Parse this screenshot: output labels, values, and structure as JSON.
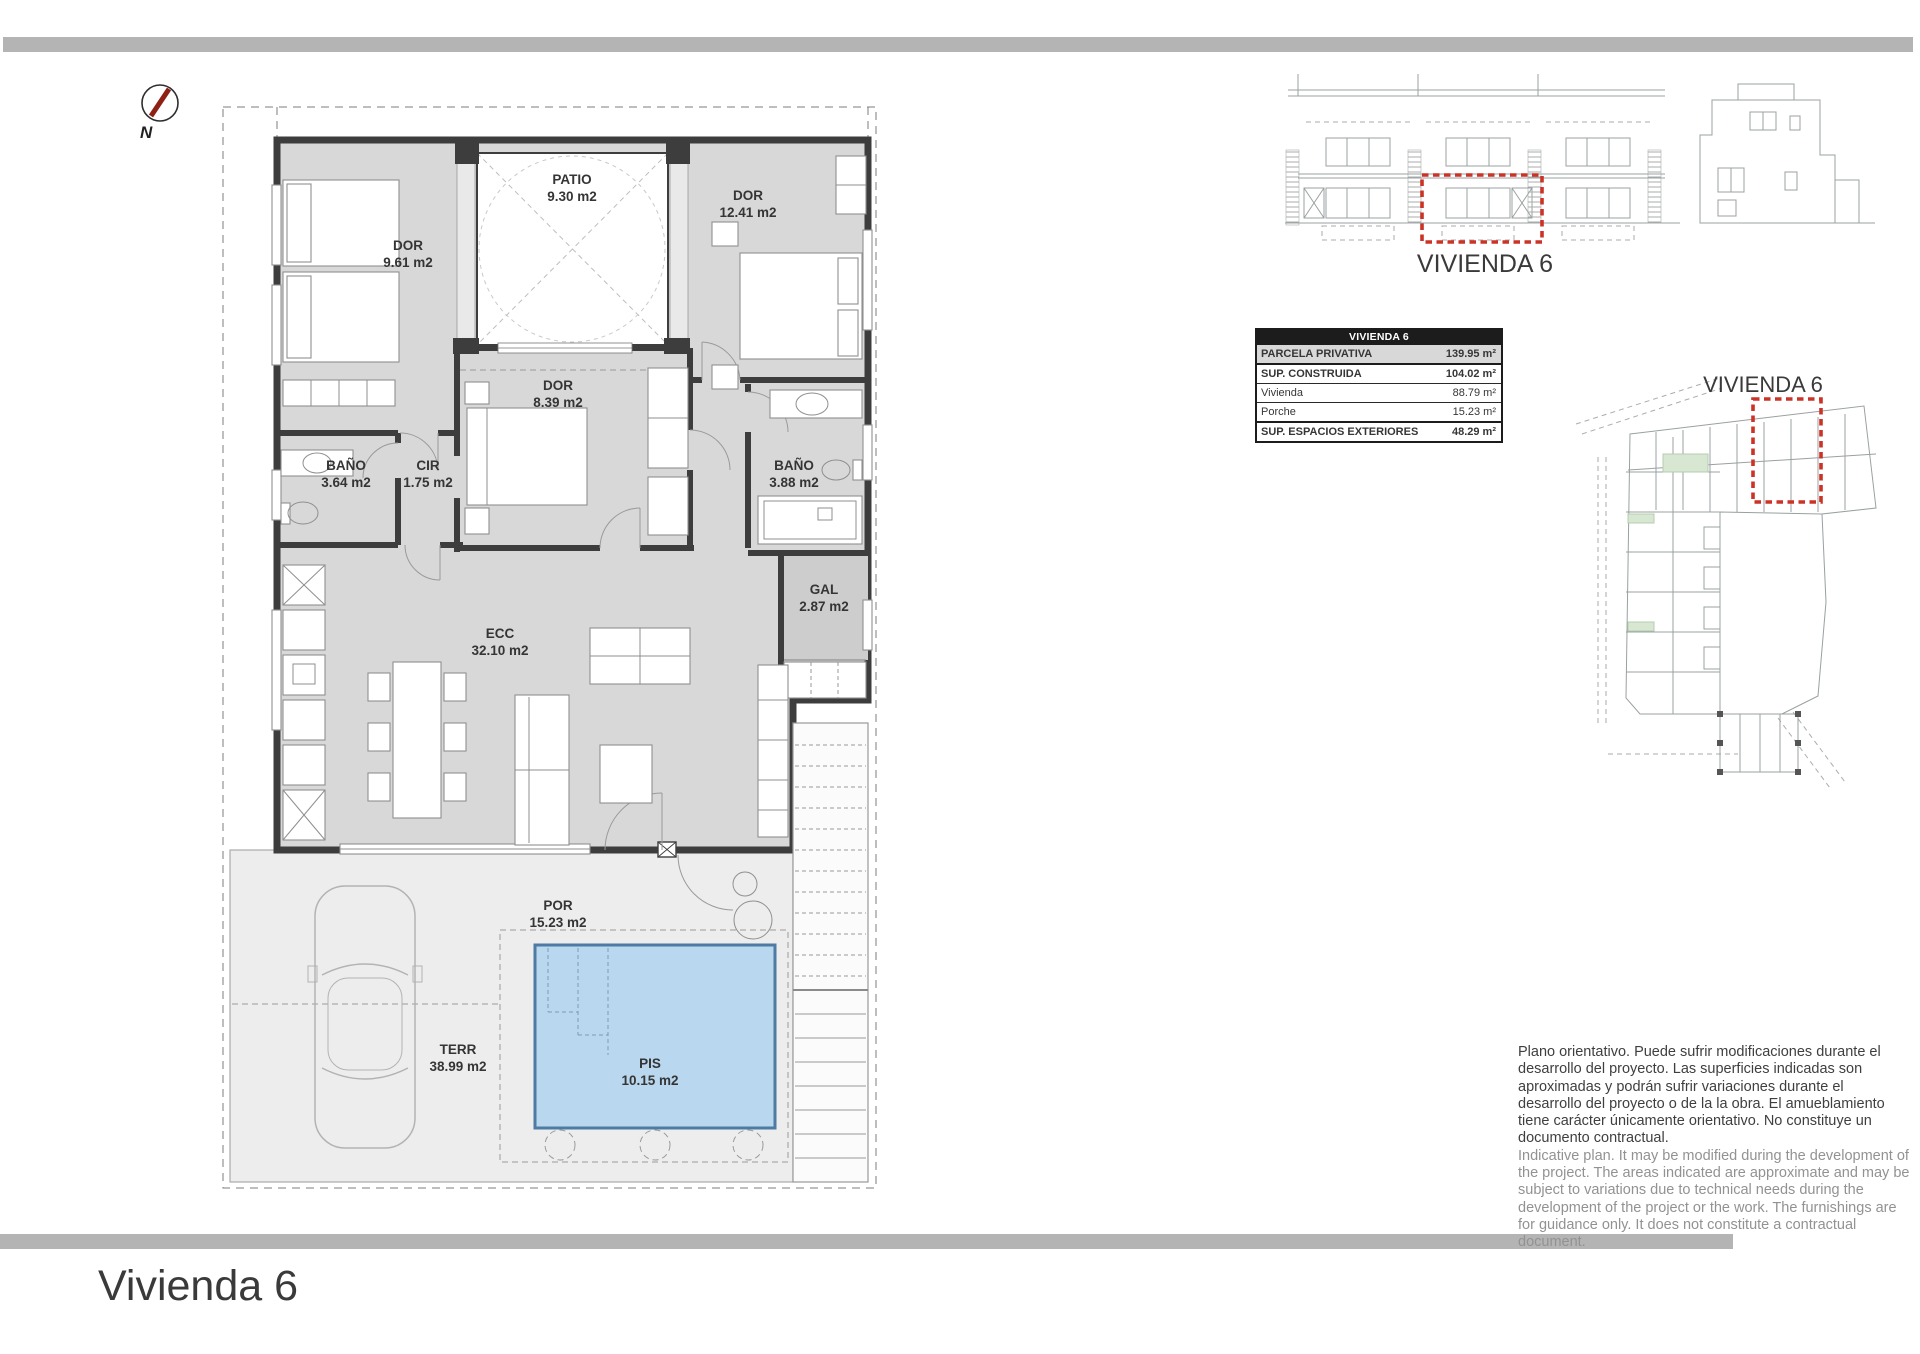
{
  "page": {
    "title": "Vivienda 6"
  },
  "compass": {
    "label": "N"
  },
  "floor_plan": {
    "rooms": [
      {
        "id": "patio",
        "name": "PATIO",
        "area": "9.30 m2"
      },
      {
        "id": "dor1",
        "name": "DOR",
        "area": "9.61 m2"
      },
      {
        "id": "dor2",
        "name": "DOR",
        "area": "12.41 m2"
      },
      {
        "id": "dor3",
        "name": "DOR",
        "area": "8.39 m2"
      },
      {
        "id": "bano1",
        "name": "BAÑO",
        "area": "3.64 m2"
      },
      {
        "id": "cir",
        "name": "CIR",
        "area": "1.75 m2"
      },
      {
        "id": "bano2",
        "name": "BAÑO",
        "area": "3.88 m2"
      },
      {
        "id": "gal",
        "name": "GAL",
        "area": "2.87 m2"
      },
      {
        "id": "ecc",
        "name": "ECC",
        "area": "32.10 m2"
      },
      {
        "id": "por",
        "name": "POR",
        "area": "15.23 m2"
      },
      {
        "id": "terr",
        "name": "TERR",
        "area": "38.99 m2"
      },
      {
        "id": "pis",
        "name": "PIS",
        "area": "10.15 m2"
      }
    ]
  },
  "elevation": {
    "caption": "VIVIENDA 6"
  },
  "site_plan": {
    "caption": "VIVIENDA 6"
  },
  "summary_table": {
    "header": "VIVIENDA 6",
    "rows": [
      {
        "label": "PARCELA PRIVATIVA",
        "value": "139.95 m²"
      },
      {
        "label": "SUP. CONSTRUIDA",
        "value": "104.02 m²"
      },
      {
        "label": "Vivienda",
        "value": "88.79 m²"
      },
      {
        "label": "Porche",
        "value": "15.23 m²"
      },
      {
        "label": "SUP. ESPACIOS EXTERIORES",
        "value": "48.29 m²"
      }
    ]
  },
  "disclaimer": {
    "es": "Plano orientativo. Puede sufrir modificaciones durante el desarrollo del proyecto. Las superficies indicadas son aproximadas y podrán sufrir variaciones durante el desarrollo del proyecto o de la la obra. El amueblamiento tiene carácter únicamente orientativo. No constituye un documento contractual.",
    "en": "Indicative plan. It may be modified during the development of the project. The areas indicated are approximate and may be subject to variations due to technical needs during the development of the project or the work. The furnishings are for guidance only. It does not constitute a contractual document."
  },
  "colors": {
    "accent_red": "#cc3327",
    "pool_blue": "#b9d7ee",
    "wall_dark": "#3d3d3d",
    "bar_gray": "#b4b4b4"
  }
}
